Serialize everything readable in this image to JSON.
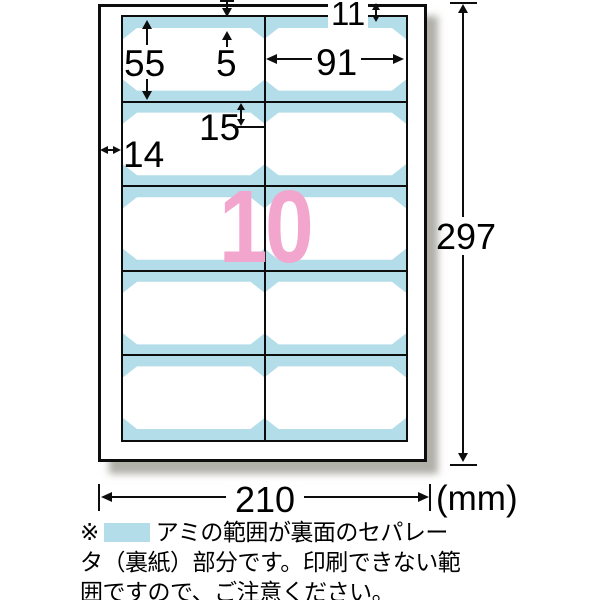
{
  "sheet": {
    "columns": 2,
    "rows": 5,
    "cell_count": 10
  },
  "count_text": "10",
  "dims": {
    "top_margin": "11",
    "label_height": "55",
    "band_top": "5",
    "label_width": "91",
    "slit_offset": "15",
    "side_margin": "14",
    "page_height": "297",
    "page_width": "210",
    "unit": "(mm)"
  },
  "note": {
    "marker": "※",
    "line1": "アミの範囲が裏面のセパレー",
    "line2": "タ（裏紙）部分です。印刷できない範",
    "line3": "囲ですので、ご注意ください。"
  },
  "colors": {
    "separator_blue": "#B2DDE9",
    "count_pink": "#F2A6CD"
  }
}
